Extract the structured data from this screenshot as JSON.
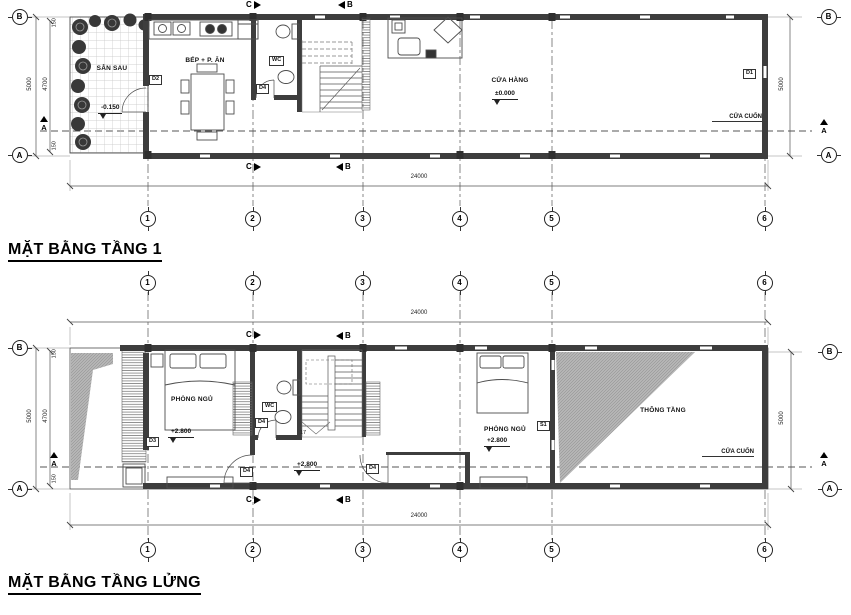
{
  "sheet": {
    "background": "#ffffff",
    "ink": "#3d3d3d",
    "shade": "#b5b5b5"
  },
  "grid": {
    "cols": [
      "1",
      "2",
      "3",
      "4",
      "5",
      "6"
    ],
    "rows": {
      "b": "B",
      "a": "A"
    }
  },
  "sections": {
    "a": "A",
    "b": "B",
    "c": "C"
  },
  "dims": {
    "total": "24000",
    "height": "5000",
    "inner": "4700",
    "wall": "150"
  },
  "plan1": {
    "title": "MẶT BẰNG TẦNG 1",
    "rooms": {
      "yard": "SÂN SAU",
      "kitchen": "BẾP + P. ĂN",
      "wc": "WC",
      "shop": "CỬA HÀNG"
    },
    "levels": {
      "yard": "-0.150",
      "shop": "±0.000"
    },
    "tags": {
      "d1": "D1",
      "d2": "D2",
      "d4": "D4"
    },
    "rolling_door": "CỬA CUỐN"
  },
  "plan2": {
    "title": "MẶT BẰNG TẦNG LỬNG",
    "rooms": {
      "bedroom1": "PHÒNG NGỦ",
      "wc": "WC",
      "bedroom2": "PHÒNG NGỦ",
      "void": "THÔNG TẦNG"
    },
    "levels": {
      "bedroom1": "+2.800",
      "hall": "+2.800",
      "bedroom2": "+2.800"
    },
    "tags": {
      "d3": "D3",
      "d4": "D4",
      "s1": "S1",
      "stair_steps": "17"
    },
    "rolling_door": "CỬA CUỐN"
  }
}
